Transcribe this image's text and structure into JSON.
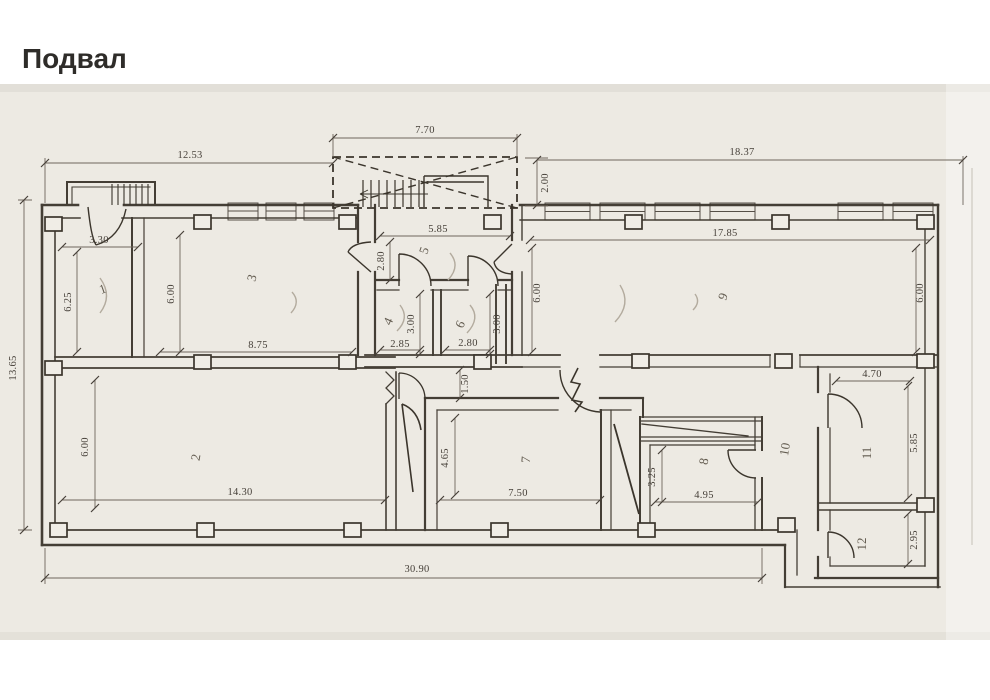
{
  "title": "Подвал",
  "plan": {
    "overall": {
      "bottom_width": "30.90",
      "left_height": "13.65",
      "top_left_width": "12.53",
      "top_right_width": "18.37"
    },
    "stairwell": {
      "width": "7.70",
      "depth": "2.00"
    },
    "corridor": {
      "width": "1.50"
    },
    "rooms": [
      {
        "number": "1",
        "w": "3.30",
        "h": "6.25"
      },
      {
        "number": "2",
        "w": "14.30",
        "h": "6.00"
      },
      {
        "number": "3",
        "w": "8.75",
        "h": "6.00"
      },
      {
        "number": "4",
        "w": "2.85",
        "h": "3.00"
      },
      {
        "number": "5",
        "w": "5.85",
        "h": "2.80"
      },
      {
        "number": "6",
        "w": "2.80",
        "h": "3.00"
      },
      {
        "number": "7",
        "w": "7.50",
        "h": "4.65"
      },
      {
        "number": "8",
        "w": "4.95",
        "h": "3.25"
      },
      {
        "number": "9",
        "w": "17.85",
        "h": "6.00"
      },
      {
        "number": "10"
      },
      {
        "number": "11",
        "w": "4.70",
        "h": "5.85"
      },
      {
        "number": "12",
        "h": "2.95"
      }
    ]
  },
  "colors": {
    "line": "#3b352c",
    "dim": "#6e675c",
    "paper": "#edeae3",
    "faint": "#b3ab9e"
  }
}
